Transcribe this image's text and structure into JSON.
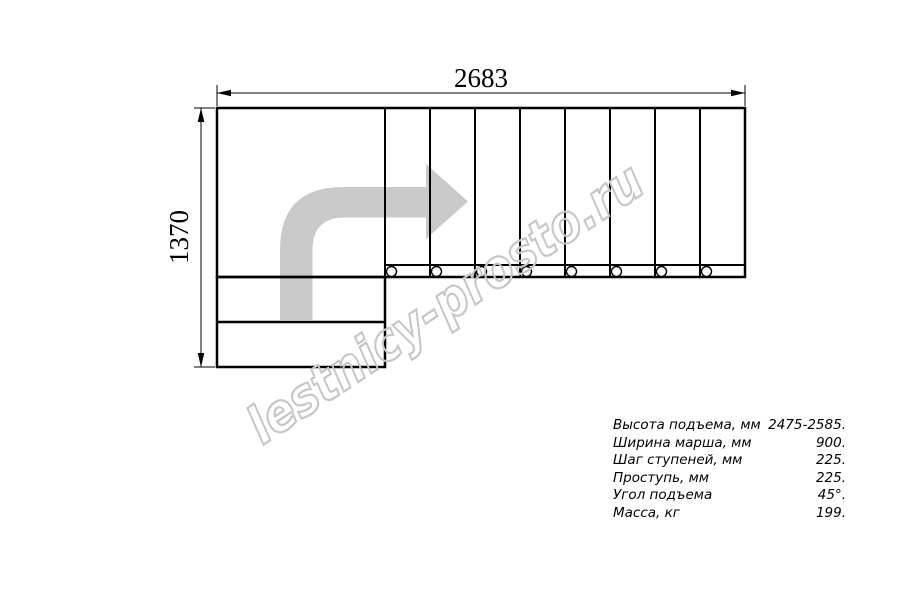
{
  "drawing": {
    "width_mm": "2683",
    "height_mm": "1370",
    "step_columns": 8,
    "colors": {
      "line": "#000000",
      "arrow": "#c9c9c9",
      "watermark": "#c6c6c6"
    }
  },
  "watermark": {
    "text": "lestnicy-prosto.ru"
  },
  "specs": {
    "rows": [
      {
        "label": "Высота подъема, мм",
        "value": "2475-2585."
      },
      {
        "label": "Ширина марша, мм",
        "value": "900."
      },
      {
        "label": "Шаг ступеней, мм",
        "value": "225."
      },
      {
        "label": "Проступь, мм",
        "value": "225."
      },
      {
        "label": "Угол подъема",
        "value": "45°."
      },
      {
        "label": "Масса, кг",
        "value": "199."
      }
    ]
  }
}
